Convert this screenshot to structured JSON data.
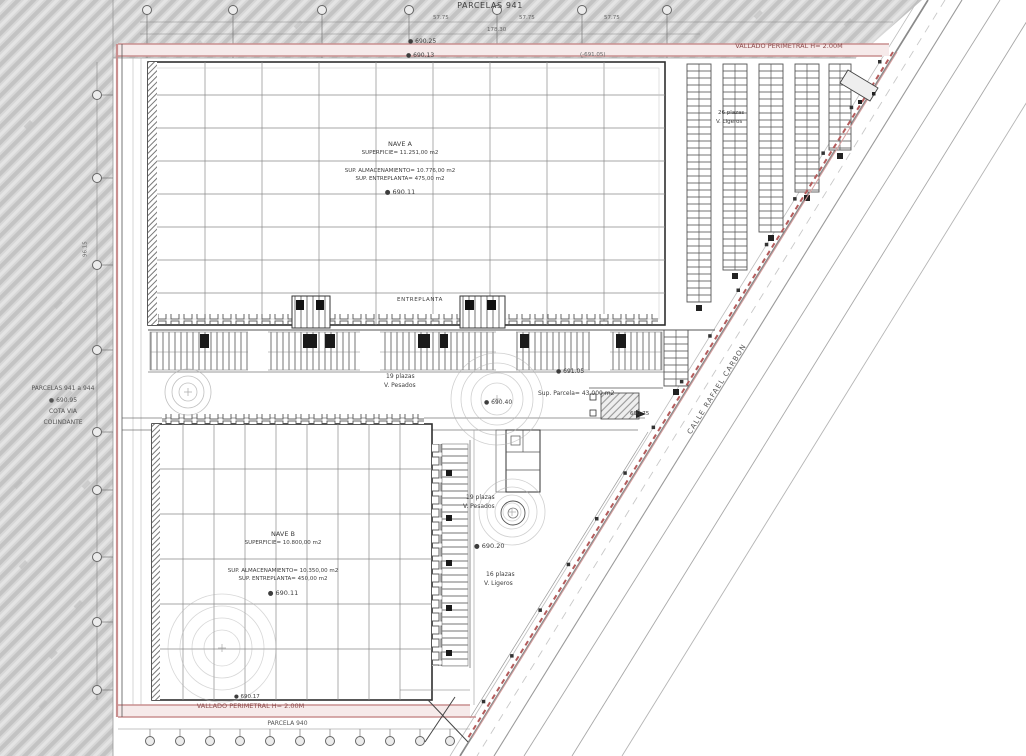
{
  "drawing": {
    "parcel_top": "PARCELAS 941",
    "parcel_bottom": "PARCELA 940",
    "fence_label_top": "VALLADO PERIMETRAL H= 2.00M",
    "fence_label_bottom": "VALLADO PERIMETRAL H= 2.00M",
    "street_name": "CALLE RAFAEL CARBON",
    "site_area": "Sup. Parcela= 43.000 m2",
    "left_parcels": {
      "title": "PARCELAS 941 a 944",
      "elevation": "● 690.95",
      "line2": "COTA VIA",
      "line3": "COLINDANTE"
    },
    "nave_a": {
      "name": "NAVE A",
      "surface": "SUPERFICIE= 11.251,00 m2",
      "storage": "SUP. ALMACENAMIENTO= 10.776,00 m2",
      "mezzanine": "SUP. ENTREPLANTA= 475,00 m2",
      "elevation": "● 690.11",
      "mezzanine_label": "ENTREPLANTA"
    },
    "nave_b": {
      "name": "NAVE B",
      "surface": "SUPERFICIE= 10.800,00 m2",
      "storage": "SUP. ALMACENAMIENTO= 10.350,00 m2",
      "mezzanine": "SUP. ENTREPLANTA= 450,00 m2",
      "elevation": "● 690.11"
    },
    "parking": {
      "trucks_mid": {
        "count": "19 plazas",
        "type": "V. Pesados"
      },
      "trucks_south": {
        "count": "19 plazas",
        "type": "V. Pesados"
      },
      "light_south": {
        "count": "16 plazas",
        "type": "V. Ligeros"
      },
      "light_east": {
        "count": "26 plazas",
        "type": "V. Ligeros"
      }
    },
    "elevations": {
      "top_a": "● 690.25",
      "top_b": "● 690.13",
      "top_c": "(-691.05)",
      "yard_high": "● 691.05",
      "yard_mid": "● 690.40",
      "gate": "690.75",
      "south": "● 690.20",
      "bottom": "● 690.17"
    },
    "dimensions": {
      "d1": "57.75",
      "d2": "57.75",
      "d3": "57.75",
      "d4": "178.30",
      "d5": "96.15"
    }
  },
  "colors": {
    "fence_pink": "#c98f8f",
    "fence_text": "#8a4a4a",
    "hatch_gray": "#d7d7d7",
    "line_dark": "#3c3c3c",
    "paper": "#ffffff"
  }
}
